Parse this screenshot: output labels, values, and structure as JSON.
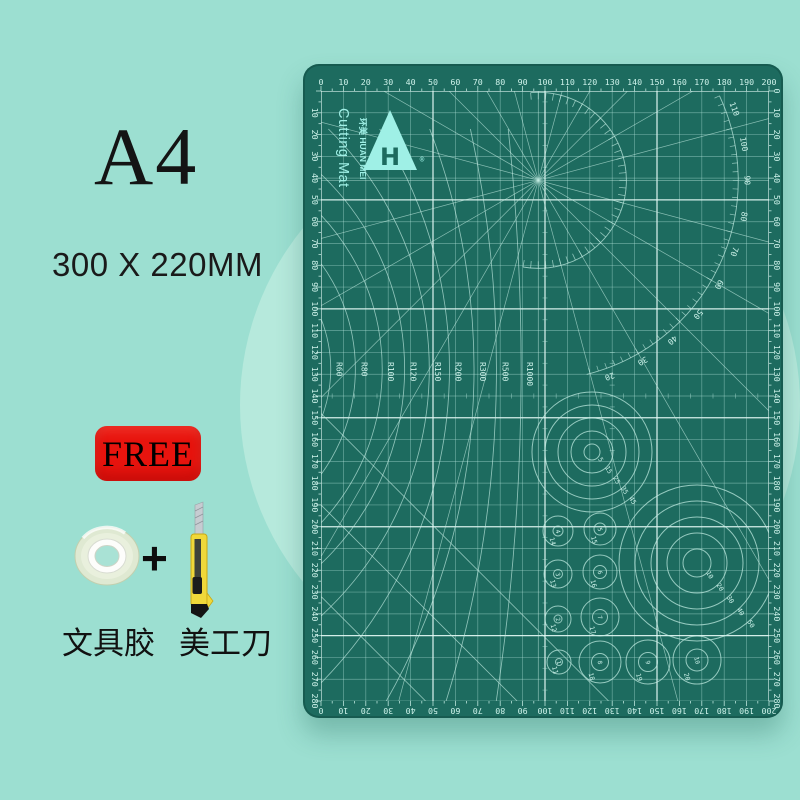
{
  "page": {
    "bg": "#9cdfd1",
    "halo": "#b6e9dc"
  },
  "left_panel": {
    "size": "A4",
    "dimensions": "300 X 220MM",
    "free": "FREE",
    "plus": "+",
    "tape_label": "文具胶",
    "knife_label": "美工刀"
  },
  "mat": {
    "colors": {
      "mat": "#1d6b5f",
      "grid_minor": "rgba(180,230,219,0.5)",
      "grid_major": "rgba(228,250,245,0.92)",
      "line": "rgba(196,238,228,0.8)",
      "ink": "#cdf2ea",
      "logo": "#9ff0e6"
    },
    "logo": {
      "brand": "环美 HUAN MEI",
      "product": "Cutting Mat",
      "registered": "®"
    },
    "rulers": {
      "top": [
        "0",
        "10",
        "20",
        "30",
        "40",
        "50",
        "60",
        "70",
        "80",
        "90",
        "100",
        "110",
        "120",
        "130",
        "140",
        "150",
        "160",
        "170",
        "180",
        "190",
        "200"
      ],
      "bottom": [
        "0",
        "10",
        "20",
        "30",
        "40",
        "50",
        "60",
        "70",
        "80",
        "90",
        "100",
        "110",
        "120",
        "130",
        "140",
        "150",
        "160",
        "170",
        "180",
        "190",
        "200"
      ],
      "left": [
        "10",
        "20",
        "30",
        "40",
        "50",
        "60",
        "70",
        "80",
        "90",
        "100",
        "110",
        "120",
        "130",
        "140",
        "150",
        "160",
        "170",
        "180",
        "190",
        "200",
        "210",
        "220",
        "230",
        "240",
        "250",
        "260",
        "270",
        "280"
      ],
      "right": [
        "0",
        "10",
        "20",
        "30",
        "40",
        "50",
        "60",
        "70",
        "80",
        "90",
        "100",
        "110",
        "120",
        "130",
        "140",
        "150",
        "160",
        "170",
        "180",
        "190",
        "200",
        "210",
        "220",
        "230",
        "240",
        "250",
        "260",
        "270",
        "280"
      ]
    },
    "protractor_labels": [
      "110",
      "100",
      "90",
      "80",
      "70",
      "60",
      "50",
      "40",
      "30",
      "20"
    ],
    "r_curves": [
      {
        "label": "R60",
        "x_mm": 7
      },
      {
        "label": "R80",
        "x_mm": 18
      },
      {
        "label": "R100",
        "x_mm": 30
      },
      {
        "label": "R120",
        "x_mm": 40
      },
      {
        "label": "R150",
        "x_mm": 51
      },
      {
        "label": "R200",
        "x_mm": 60
      },
      {
        "label": "R300",
        "x_mm": 71
      },
      {
        "label": "R500",
        "x_mm": 81
      },
      {
        "label": "R1000",
        "x_mm": 92
      }
    ],
    "circle_set_a": {
      "cx": 289,
      "cy": 388,
      "radii": [
        8,
        21,
        34,
        47,
        60
      ],
      "labels": [
        "5",
        "15",
        "25",
        "35",
        "45"
      ]
    },
    "circle_set_b": {
      "cx": 394,
      "cy": 499,
      "radii": [
        14,
        30,
        46,
        62,
        78
      ],
      "labels": [
        "10",
        "20",
        "30",
        "40",
        "50"
      ]
    },
    "small_circles": [
      {
        "inner": "4",
        "outer": "14",
        "x": 255,
        "y": 467,
        "ri": 5,
        "ro": 15
      },
      {
        "inner": "3",
        "outer": "13",
        "x": 255,
        "y": 510,
        "ri": 4.5,
        "ro": 14
      },
      {
        "inner": "2",
        "outer": "12",
        "x": 255,
        "y": 555,
        "ri": 4,
        "ro": 13
      },
      {
        "inner": "1",
        "outer": "11",
        "x": 256,
        "y": 598,
        "ri": 3.5,
        "ro": 12
      },
      {
        "inner": "5",
        "outer": "15",
        "x": 297,
        "y": 465,
        "ri": 6,
        "ro": 16
      },
      {
        "inner": "6",
        "outer": "16",
        "x": 297,
        "y": 508,
        "ri": 6.5,
        "ro": 17
      },
      {
        "inner": "7",
        "outer": "17",
        "x": 297,
        "y": 553,
        "ri": 7.5,
        "ro": 19
      },
      {
        "inner": "8",
        "outer": "18",
        "x": 297,
        "y": 598,
        "ri": 8.5,
        "ro": 21
      },
      {
        "inner": "9",
        "outer": "19",
        "x": 345,
        "y": 598,
        "ri": 9.5,
        "ro": 22
      },
      {
        "inner": "10",
        "outer": "20",
        "x": 394,
        "y": 596,
        "ri": 11,
        "ro": 24
      }
    ],
    "diagonals_mm": [
      148,
      190,
      232
    ]
  }
}
